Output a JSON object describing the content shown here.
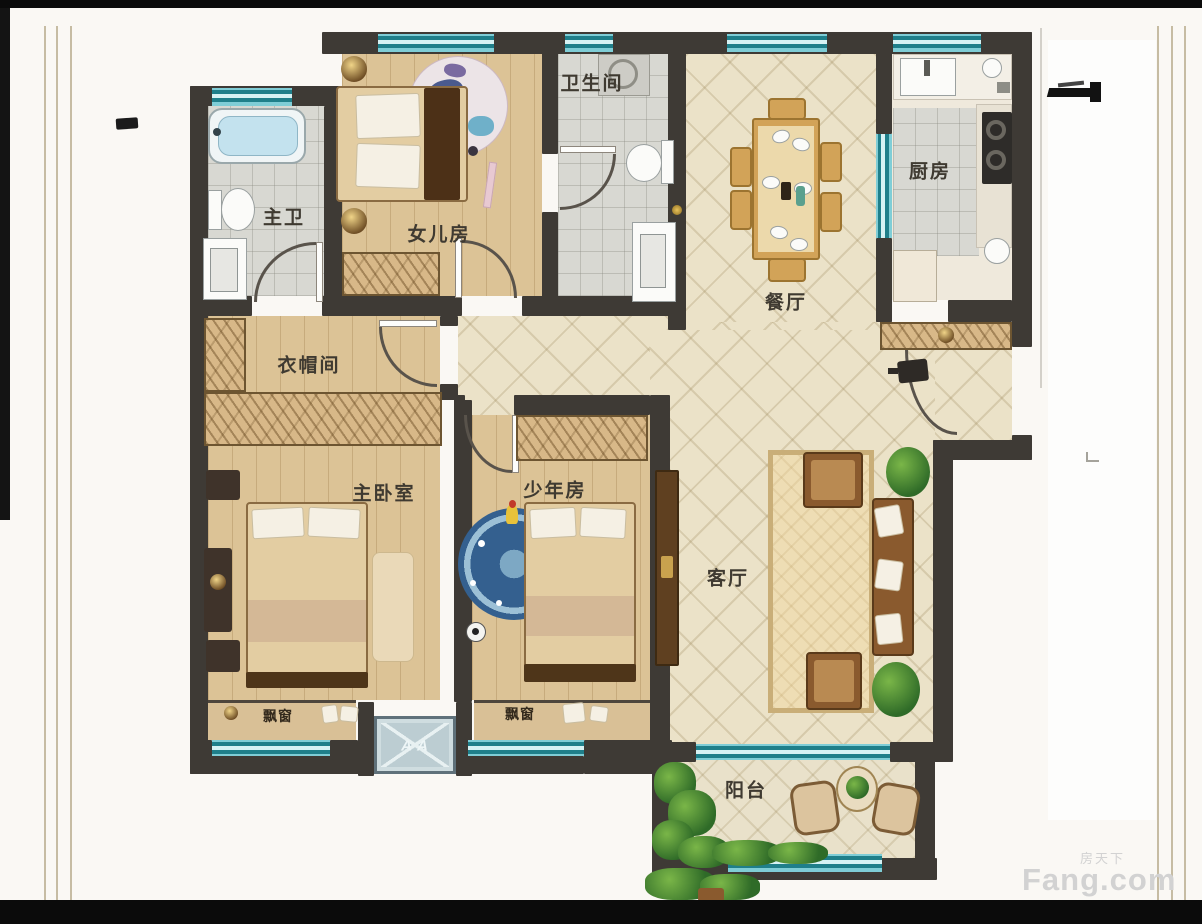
{
  "rooms": {
    "master_bath": {
      "label": "主卫"
    },
    "daughter_room": {
      "label": "女儿房"
    },
    "bathroom": {
      "label": "卫生间"
    },
    "dining": {
      "label": "餐厅"
    },
    "kitchen": {
      "label": "厨房"
    },
    "cloakroom": {
      "label": "衣帽间"
    },
    "master_bedroom": {
      "label": "主卧室"
    },
    "teen_room": {
      "label": "少年房"
    },
    "living": {
      "label": "客厅"
    },
    "balcony": {
      "label": "阳台"
    }
  },
  "annotations": {
    "bay_window_left": "飘窗",
    "bay_window_right": "飘窗",
    "ac_platform": "A A"
  },
  "watermark": {
    "site": "Fang.com",
    "site_cn": "房天下"
  },
  "colors": {
    "wall": "#3e3a35",
    "window": "#1f7f8a",
    "windowLight": "#9fdbe2",
    "woodFloor": "#dcc396",
    "tileFloor": "#ebe2c8",
    "grayTile": "#d8d8d2",
    "hatch": "#d8b888",
    "furnitureBrown": "#8a5a2e",
    "gold": "#d2a358",
    "label": "#3f3a31"
  }
}
